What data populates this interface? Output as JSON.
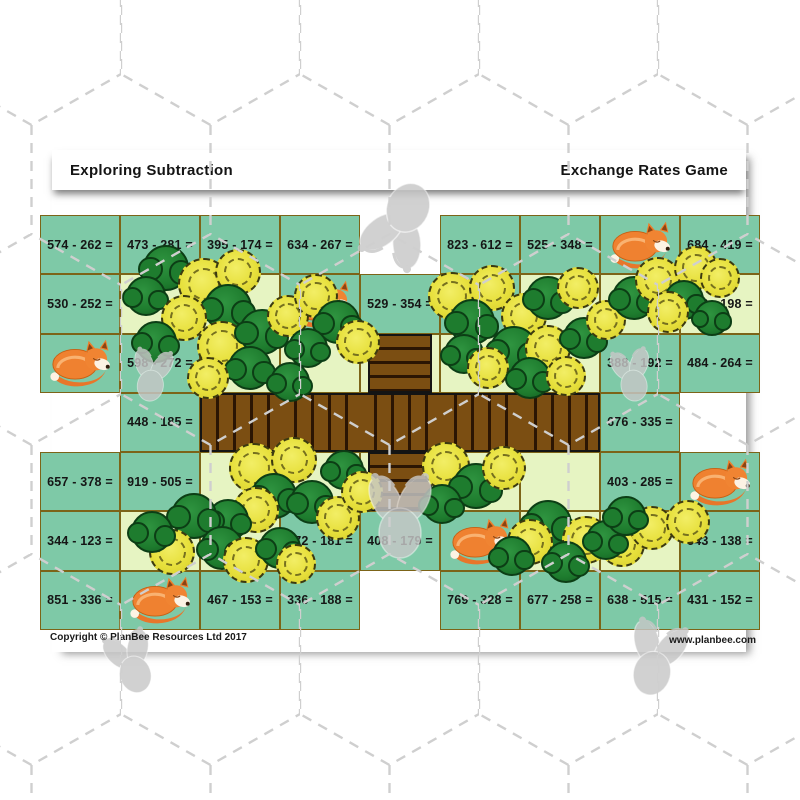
{
  "page": {
    "titles": {
      "left": "Exploring Subtraction",
      "right": "Exchange Rates Game"
    },
    "footer": {
      "copyright": "Copyright © PlanBee Resources Ltd 2017",
      "website": "www.planbee.com"
    }
  },
  "colors": {
    "cell_teal": "#7ec9a7",
    "cell_pale": "#e6f4c2",
    "grid_border": "#7c6418",
    "bridge_plank": "#7b4e12",
    "bridge_gap": "#2b1503",
    "fox_orange": "#ef8130",
    "tree_yellow": "#e7e03c",
    "bush_green": "#1e7c2e",
    "bee_grey": "#c7c7c7"
  },
  "board": {
    "columns": 9,
    "rows": 7,
    "cells": [
      {
        "t": "p",
        "v": "574 - 262 ="
      },
      {
        "t": "p",
        "v": "473 - 281 ="
      },
      {
        "t": "p",
        "v": "395 - 174 ="
      },
      {
        "t": "p",
        "v": "634 - 267 ="
      },
      {
        "t": "e"
      },
      {
        "t": "p",
        "v": "823 - 612 ="
      },
      {
        "t": "p",
        "v": "525 - 348 ="
      },
      {
        "t": "f"
      },
      {
        "t": "p",
        "v": "684 - 419 ="
      },
      {
        "t": "p",
        "v": "530 - 252 ="
      },
      {
        "t": "g"
      },
      {
        "t": "g"
      },
      {
        "t": "f"
      },
      {
        "t": "p",
        "v": "529 - 354 ="
      },
      {
        "t": "p",
        "v": "750 - 489 ="
      },
      {
        "t": "g"
      },
      {
        "t": "g"
      },
      {
        "t": "pp",
        "v": "316 - 198 ="
      },
      {
        "t": "f"
      },
      {
        "t": "p",
        "v": "598 - 272 ="
      },
      {
        "t": "g"
      },
      {
        "t": "g"
      },
      {
        "t": "bv"
      },
      {
        "t": "g"
      },
      {
        "t": "g"
      },
      {
        "t": "p",
        "v": "388 - 192 ="
      },
      {
        "t": "p",
        "v": "484 - 264 ="
      },
      {
        "t": "e"
      },
      {
        "t": "p",
        "v": "448 - 185 ="
      },
      {
        "t": "bh"
      },
      {
        "t": "bh"
      },
      {
        "t": "bh"
      },
      {
        "t": "bh"
      },
      {
        "t": "bh"
      },
      {
        "t": "p",
        "v": "676 - 335 ="
      },
      {
        "t": "e"
      },
      {
        "t": "p",
        "v": "657 - 378 ="
      },
      {
        "t": "p",
        "v": "919 - 505 ="
      },
      {
        "t": "g"
      },
      {
        "t": "g"
      },
      {
        "t": "bv"
      },
      {
        "t": "g"
      },
      {
        "t": "g"
      },
      {
        "t": "p",
        "v": "403 - 285 ="
      },
      {
        "t": "f"
      },
      {
        "t": "p",
        "v": "344 - 123 ="
      },
      {
        "t": "g"
      },
      {
        "t": "g"
      },
      {
        "t": "p",
        "v": "372 - 181 ="
      },
      {
        "t": "p",
        "v": "408 - 179 ="
      },
      {
        "t": "f"
      },
      {
        "t": "g"
      },
      {
        "t": "g"
      },
      {
        "t": "p",
        "v": "543 - 138 ="
      },
      {
        "t": "p",
        "v": "851 - 336 ="
      },
      {
        "t": "f"
      },
      {
        "t": "p",
        "v": "467 - 153 ="
      },
      {
        "t": "p",
        "v": "336 - 188 ="
      },
      {
        "t": "e"
      },
      {
        "t": "p",
        "v": "769 - 328 ="
      },
      {
        "t": "p",
        "v": "677 - 258 ="
      },
      {
        "t": "p",
        "v": "638 - 515 ="
      },
      {
        "t": "p",
        "v": "431 - 152 ="
      }
    ]
  },
  "decorations": [
    [
      "bee",
      400,
      225,
      100,
      205
    ],
    [
      "bee",
      152,
      374,
      62,
      8
    ],
    [
      "bee",
      632,
      374,
      62,
      -10
    ],
    [
      "bee",
      400,
      514,
      100,
      0
    ],
    [
      "bee",
      131,
      661,
      74,
      -18
    ],
    [
      "bee",
      656,
      657,
      88,
      14
    ],
    [
      "bush",
      166,
      268,
      46
    ],
    [
      "tree",
      204,
      284,
      52
    ],
    [
      "bush",
      146,
      296,
      40
    ],
    [
      "tree",
      238,
      272,
      46
    ],
    [
      "bush",
      228,
      308,
      48
    ],
    [
      "tree",
      184,
      318,
      46
    ],
    [
      "bush",
      156,
      342,
      42
    ],
    [
      "tree",
      222,
      346,
      50
    ],
    [
      "bush",
      262,
      332,
      46
    ],
    [
      "tree",
      288,
      316,
      42
    ],
    [
      "bush",
      250,
      368,
      44
    ],
    [
      "tree",
      208,
      378,
      42
    ],
    [
      "bush",
      290,
      382,
      40
    ],
    [
      "tree",
      316,
      296,
      44
    ],
    [
      "bush",
      338,
      322,
      44
    ],
    [
      "tree",
      358,
      342,
      44
    ],
    [
      "bush",
      308,
      348,
      40
    ],
    [
      "tree",
      452,
      296,
      48
    ],
    [
      "tree",
      492,
      288,
      46
    ],
    [
      "bush",
      472,
      322,
      46
    ],
    [
      "tree",
      524,
      316,
      46
    ],
    [
      "bush",
      548,
      298,
      44
    ],
    [
      "tree",
      578,
      288,
      42
    ],
    [
      "bush",
      514,
      350,
      48
    ],
    [
      "tree",
      548,
      348,
      46
    ],
    [
      "bush",
      584,
      338,
      42
    ],
    [
      "tree",
      606,
      320,
      40
    ],
    [
      "bush",
      464,
      354,
      40
    ],
    [
      "tree",
      488,
      368,
      42
    ],
    [
      "bush",
      530,
      378,
      42
    ],
    [
      "tree",
      566,
      376,
      40
    ],
    [
      "bush",
      634,
      298,
      44
    ],
    [
      "tree",
      658,
      280,
      46
    ],
    [
      "tree",
      696,
      268,
      44
    ],
    [
      "bush",
      684,
      300,
      40
    ],
    [
      "tree",
      720,
      278,
      40
    ],
    [
      "bush",
      712,
      318,
      36
    ],
    [
      "tree",
      668,
      312,
      42
    ],
    [
      "tree",
      254,
      468,
      50
    ],
    [
      "tree",
      294,
      460,
      46
    ],
    [
      "bush",
      274,
      496,
      46
    ],
    [
      "tree",
      256,
      510,
      46
    ],
    [
      "bush",
      228,
      520,
      42
    ],
    [
      "bush",
      312,
      502,
      44
    ],
    [
      "tree",
      338,
      518,
      44
    ],
    [
      "bush",
      194,
      516,
      46
    ],
    [
      "tree",
      172,
      552,
      46
    ],
    [
      "bush",
      152,
      532,
      42
    ],
    [
      "bush",
      222,
      548,
      44
    ],
    [
      "tree",
      246,
      560,
      46
    ],
    [
      "bush",
      280,
      548,
      42
    ],
    [
      "tree",
      296,
      564,
      40
    ],
    [
      "bush",
      344,
      470,
      40
    ],
    [
      "tree",
      362,
      492,
      42
    ],
    [
      "tree",
      446,
      466,
      48
    ],
    [
      "bush",
      476,
      486,
      46
    ],
    [
      "tree",
      504,
      468,
      44
    ],
    [
      "bush",
      442,
      504,
      40
    ],
    [
      "bush",
      548,
      524,
      48
    ],
    [
      "tree",
      530,
      542,
      46
    ],
    [
      "tree",
      586,
      540,
      48
    ],
    [
      "bush",
      566,
      562,
      42
    ],
    [
      "tree",
      622,
      544,
      46
    ],
    [
      "bush",
      606,
      540,
      40
    ],
    [
      "tree",
      652,
      528,
      44
    ],
    [
      "bush",
      626,
      516,
      40
    ],
    [
      "tree",
      688,
      522,
      44
    ],
    [
      "bush",
      512,
      556,
      40
    ]
  ]
}
